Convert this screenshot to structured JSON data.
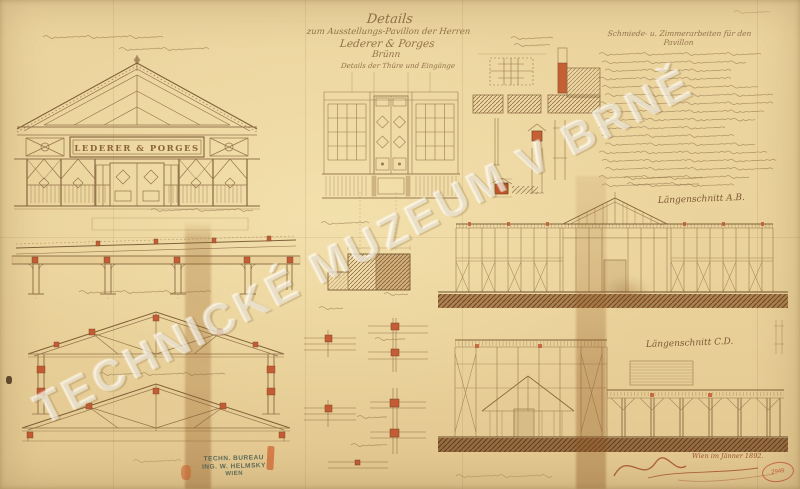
{
  "sheet": {
    "watermark": "TECHNICKÉ MUZEUM V BRNĚ",
    "title_block": {
      "line1": "Details",
      "line2": "zum Ausstellungs-Pavillon der Herren",
      "line3": "Lederer & Porges",
      "line4": "Brünn",
      "subtitle": "Details der Thüre und Eingänge"
    },
    "facade_sign": "LEDERER & PORGES",
    "spec_heading": "Schmiede- u. Zimmerarbeiten für den Pavillon",
    "section_labels": {
      "ab": "Längenschnitt A.B.",
      "cd": "Längenschnitt C.D."
    },
    "bureau_stamp": {
      "line1": "TECHN. BUREAU",
      "line2": "ING. W. HELMSKY",
      "line3": "WIEN"
    },
    "signature_date": "Wien im Jänner 1892.",
    "archive_stamp_number": "2949",
    "colors": {
      "paper": "#ead29b",
      "ink": "#8b6a42",
      "accent_red": "#c0502a",
      "stamp_teal": "#4a5f54",
      "stamp_red": "#c0392b"
    }
  }
}
